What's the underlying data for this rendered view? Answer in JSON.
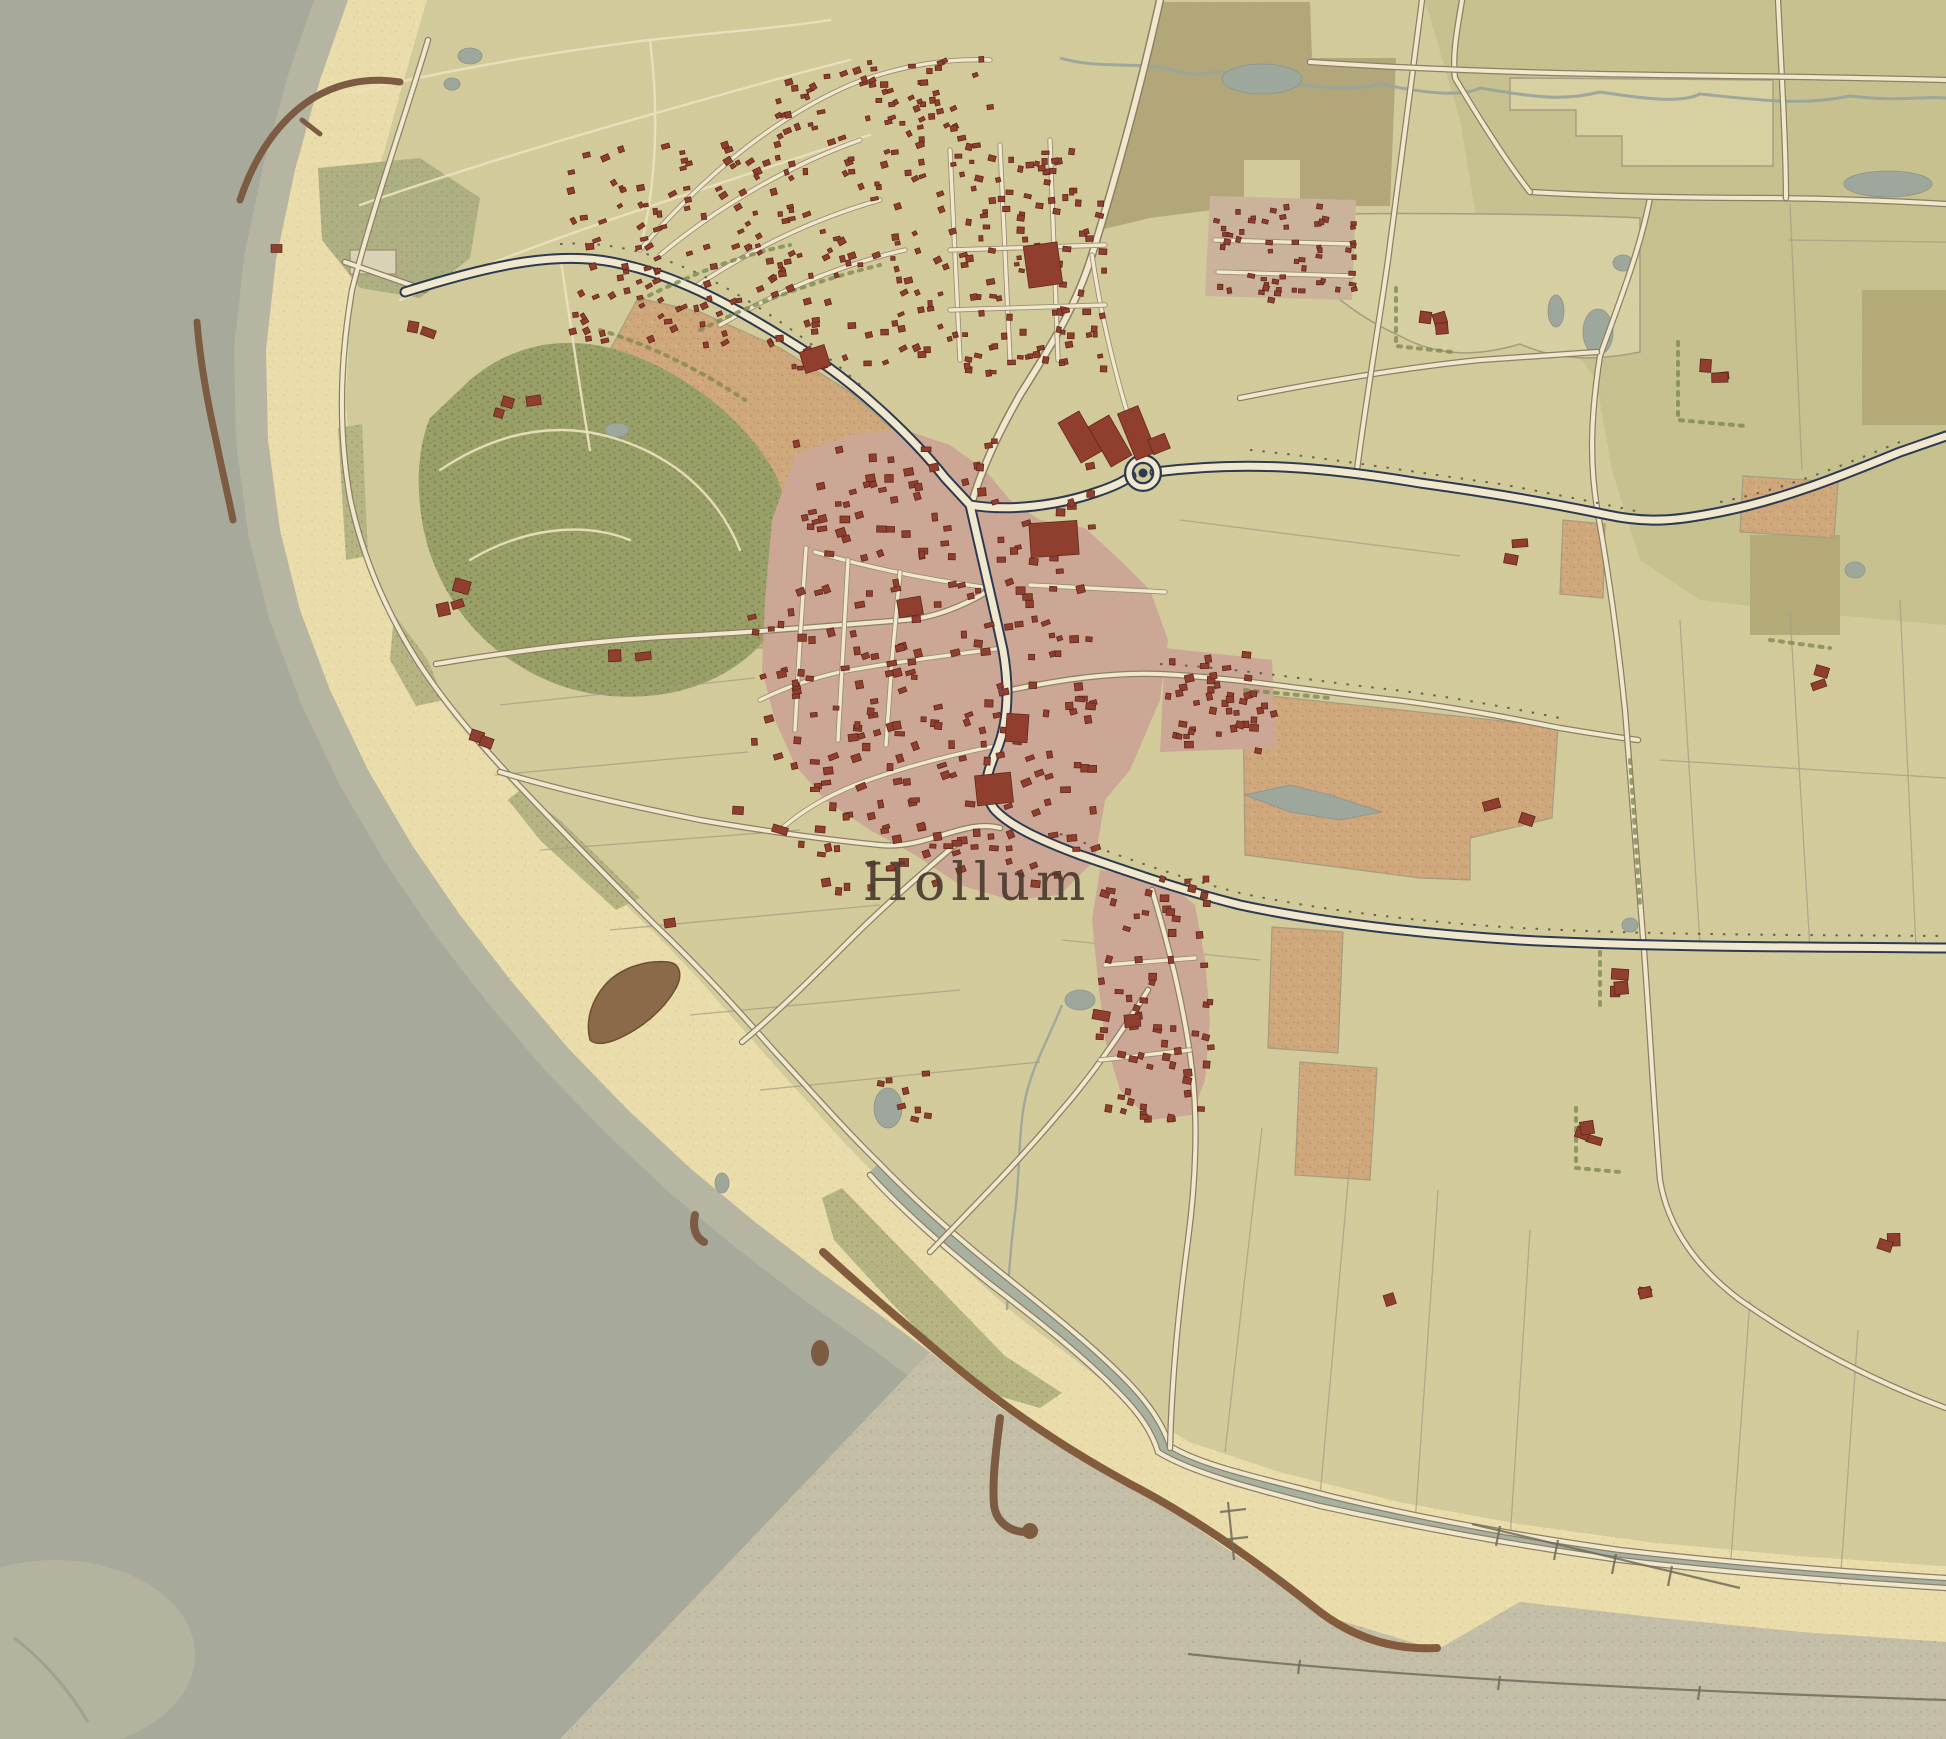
{
  "map": {
    "region_name": "Hollum",
    "place_labels": [
      {
        "text": "Hollum",
        "x": 977,
        "y": 900,
        "font_size": 52,
        "letter_spacing": 6
      }
    ],
    "features": [
      "sea",
      "tidal-flats",
      "beach",
      "dunes",
      "forest",
      "plowed-fields",
      "village-hollum",
      "holiday-park",
      "groynes",
      "sea-dike",
      "roads",
      "farmsteads"
    ],
    "colors": {
      "sea": "#a7aa9b",
      "wetsand": "#c6c2ab",
      "beach": "#ecdfac",
      "flats": "#c5bfa8",
      "land": "#d4cc9b",
      "field_dark": "#b3a779",
      "field_pale": "#d9d2a2",
      "olive": "#c7c28e",
      "olive_dark": "#b5ab77",
      "orange": "#d0a87b",
      "forest": "#99a066",
      "scrub": "#aeb183",
      "dunegrass": "#b7b583",
      "slack": "#d8d1a3",
      "pink": "#cda795",
      "pink2": "#cbb49a",
      "road_fill": "#f3ead0",
      "road_case": "#8b7f63",
      "navy": "#28374f",
      "path": "#ece2bf",
      "pond": "#9da79c",
      "stream": "#9aa49d",
      "dike": "#a8b2a1",
      "groyne": "#7b5940",
      "seawall": "#82593a",
      "building": "#8f3b2b",
      "building_dark": "#5f2418",
      "hedge": "#7e8a4e",
      "label": "#4a392e",
      "grid_line": "#a59c80",
      "tick": "#3f4a42",
      "parking": "#dbd4b6"
    },
    "building_clusters": [
      {
        "name": "holiday-park-fan",
        "x": 565,
        "y": 140,
        "w": 225,
        "h": 205,
        "count": 120,
        "smin": 4,
        "smax": 8,
        "rot": -20
      },
      {
        "name": "holiday-park-mid",
        "x": 775,
        "y": 58,
        "w": 185,
        "h": 310,
        "count": 130,
        "smin": 4,
        "smax": 8,
        "rot": -15
      },
      {
        "name": "holiday-park-east",
        "x": 952,
        "y": 138,
        "w": 150,
        "h": 235,
        "count": 105,
        "smin": 4,
        "smax": 8,
        "rot": 0
      },
      {
        "name": "park-grid-block",
        "x": 1212,
        "y": 202,
        "w": 140,
        "h": 96,
        "count": 55,
        "smin": 4,
        "smax": 7,
        "rot": 0
      },
      {
        "name": "park-north-spine",
        "x": 856,
        "y": 52,
        "w": 140,
        "h": 80,
        "count": 22,
        "smin": 4,
        "smax": 7,
        "rot": -15
      },
      {
        "name": "village-core",
        "x": 792,
        "y": 438,
        "w": 300,
        "h": 450,
        "count": 250,
        "smin": 5,
        "smax": 10,
        "rot": -8
      },
      {
        "name": "village-east-arm",
        "x": 1162,
        "y": 648,
        "w": 115,
        "h": 108,
        "count": 42,
        "smin": 5,
        "smax": 9,
        "rot": 0
      },
      {
        "name": "village-south-tail",
        "x": 1096,
        "y": 872,
        "w": 112,
        "h": 250,
        "count": 66,
        "smin": 5,
        "smax": 9,
        "rot": 6
      },
      {
        "name": "village-west-fringe",
        "x": 744,
        "y": 556,
        "w": 54,
        "h": 208,
        "count": 16,
        "smin": 5,
        "smax": 9,
        "rot": -5
      },
      {
        "name": "hamlet-south",
        "x": 868,
        "y": 1068,
        "w": 58,
        "h": 74,
        "count": 8,
        "smin": 5,
        "smax": 9,
        "rot": 0
      }
    ],
    "landmark_buildings": [
      {
        "x": 1026,
        "y": 244,
        "w": 34,
        "h": 42,
        "rot": -8
      },
      {
        "x": 1068,
        "y": 414,
        "w": 24,
        "h": 46,
        "rot": -30
      },
      {
        "x": 1098,
        "y": 418,
        "w": 24,
        "h": 46,
        "rot": -30
      },
      {
        "x": 1126,
        "y": 408,
        "w": 22,
        "h": 50,
        "rot": -22
      },
      {
        "x": 1150,
        "y": 436,
        "w": 18,
        "h": 16,
        "rot": -22
      },
      {
        "x": 1030,
        "y": 522,
        "w": 48,
        "h": 34,
        "rot": -4
      },
      {
        "x": 1006,
        "y": 714,
        "w": 22,
        "h": 28,
        "rot": 4
      },
      {
        "x": 976,
        "y": 774,
        "w": 36,
        "h": 30,
        "rot": -6
      },
      {
        "x": 802,
        "y": 348,
        "w": 26,
        "h": 22,
        "rot": -18
      },
      {
        "x": 898,
        "y": 598,
        "w": 24,
        "h": 18,
        "rot": -10
      }
    ],
    "farmsteads": [
      {
        "x": 286,
        "y": 248,
        "n": 1
      },
      {
        "x": 424,
        "y": 322,
        "n": 2
      },
      {
        "x": 514,
        "y": 394,
        "n": 3
      },
      {
        "x": 448,
        "y": 594,
        "n": 3
      },
      {
        "x": 490,
        "y": 732,
        "n": 2
      },
      {
        "x": 616,
        "y": 642,
        "n": 2
      },
      {
        "x": 752,
        "y": 818,
        "n": 2
      },
      {
        "x": 657,
        "y": 906,
        "n": 1
      },
      {
        "x": 1420,
        "y": 310,
        "n": 3
      },
      {
        "x": 1702,
        "y": 370,
        "n": 3
      },
      {
        "x": 1504,
        "y": 550,
        "n": 2
      },
      {
        "x": 1796,
        "y": 678,
        "n": 2
      },
      {
        "x": 1500,
        "y": 808,
        "n": 2
      },
      {
        "x": 1622,
        "y": 978,
        "n": 3
      },
      {
        "x": 1596,
        "y": 1134,
        "n": 3
      },
      {
        "x": 1868,
        "y": 1242,
        "n": 2
      },
      {
        "x": 1106,
        "y": 1024,
        "n": 2
      },
      {
        "x": 1380,
        "y": 1292,
        "n": 1
      },
      {
        "x": 1656,
        "y": 1290,
        "n": 2
      }
    ]
  }
}
